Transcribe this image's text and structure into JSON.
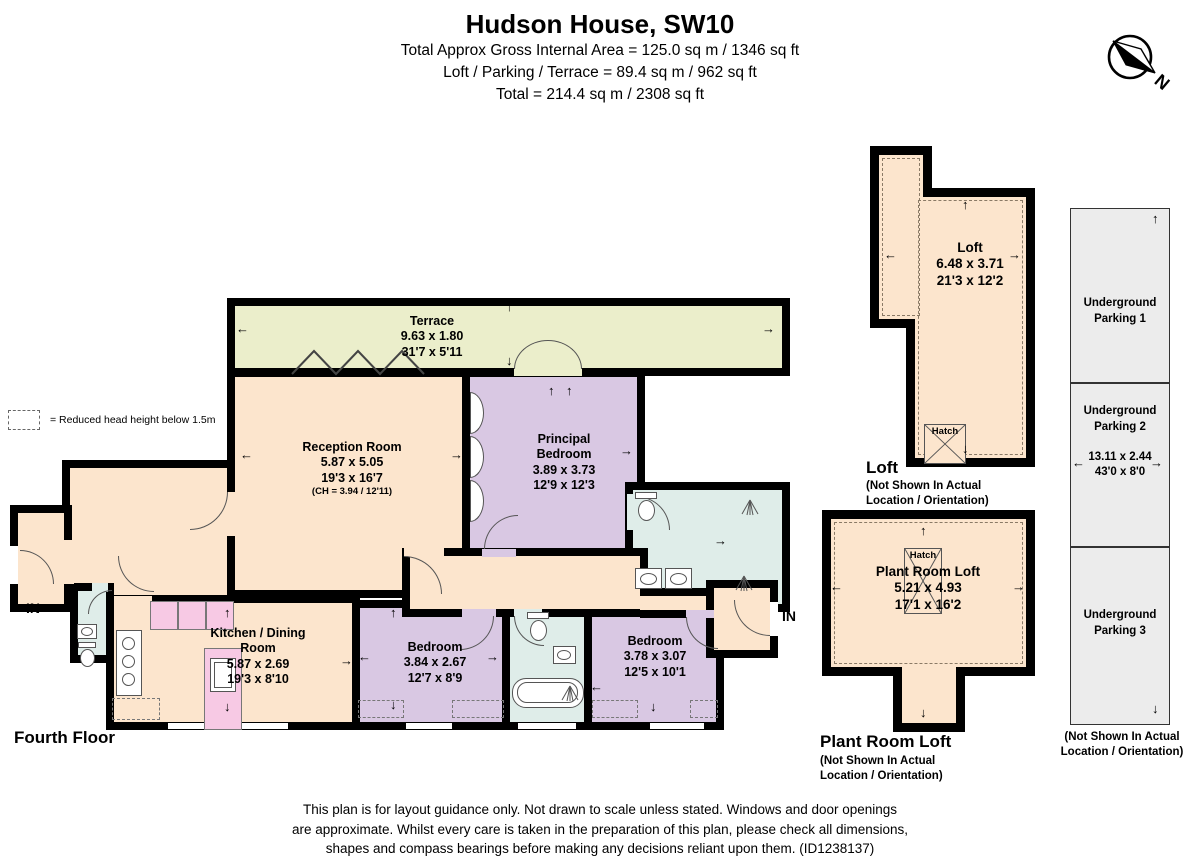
{
  "header": {
    "title": "Hudson House, SW10",
    "lines": [
      "Total Approx Gross Internal Area = 125.0 sq m / 1346 sq ft",
      "Loft / Parking / Terrace = 89.4 sq m / 962 sq ft",
      "Total = 214.4 sq m / 2308 sq ft"
    ]
  },
  "compass": {
    "label": "N"
  },
  "legend": {
    "text": "= Reduced head height below 1.5m"
  },
  "icons": {
    "arrow_left": "←",
    "arrow_right": "→",
    "arrow_up": "↑",
    "arrow_down": "↓"
  },
  "fourth_floor": {
    "label": "Fourth Floor",
    "entry_left": "IN",
    "entry_right": "IN",
    "rooms": {
      "terrace": {
        "name": "Terrace",
        "dims_m": "9.63 x 1.80",
        "dims_ft": "31'7 x 5'11"
      },
      "reception": {
        "name": "Reception Room",
        "dims_m": "5.87 x 5.05",
        "dims_ft": "19'3 x 16'7",
        "ceiling": "(CH = 3.94 / 12'11)"
      },
      "principal_bedroom": {
        "name": "Principal Bedroom",
        "dims_m": "3.89 x 3.73",
        "dims_ft": "12'9 x 12'3"
      },
      "kitchen": {
        "name": "Kitchen / Dining Room",
        "dims_m": "5.87 x 2.69",
        "dims_ft": "19'3 x 8'10"
      },
      "bedroom_left": {
        "name": "Bedroom",
        "dims_m": "3.84 x 2.67",
        "dims_ft": "12'7 x 8'9"
      },
      "bedroom_right": {
        "name": "Bedroom",
        "dims_m": "3.78 x 3.07",
        "dims_ft": "12'5 x 10'1"
      }
    }
  },
  "loft": {
    "heading": "Loft",
    "note": "(Not Shown In Actual Location / Orientation)",
    "name": "Loft",
    "dims_m": "6.48 x 3.71",
    "dims_ft": "21'3 x 12'2",
    "hatch": "Hatch"
  },
  "plant_room": {
    "heading": "Plant Room Loft",
    "note": "(Not Shown In Actual Location / Orientation)",
    "name": "Plant Room Loft",
    "dims_m": "5.21 x 4.93",
    "dims_ft": "17'1 x 16'2",
    "hatch": "Hatch"
  },
  "parking": {
    "spaces": [
      "Underground Parking 1",
      "Underground Parking 2",
      "Underground Parking 3"
    ],
    "dims_m": "13.11 x 2.44",
    "dims_ft": "43'0 x 8'0",
    "note": "(Not Shown In Actual Location / Orientation)"
  },
  "footer": {
    "lines": [
      "This plan is for layout guidance only. Not drawn to scale unless stated. Windows and door openings",
      "are approximate. Whilst every care is taken in the preparation of this plan, please check all dimensions,",
      "shapes and compass bearings before making any decisions reliant upon them. (ID1238137)"
    ]
  }
}
